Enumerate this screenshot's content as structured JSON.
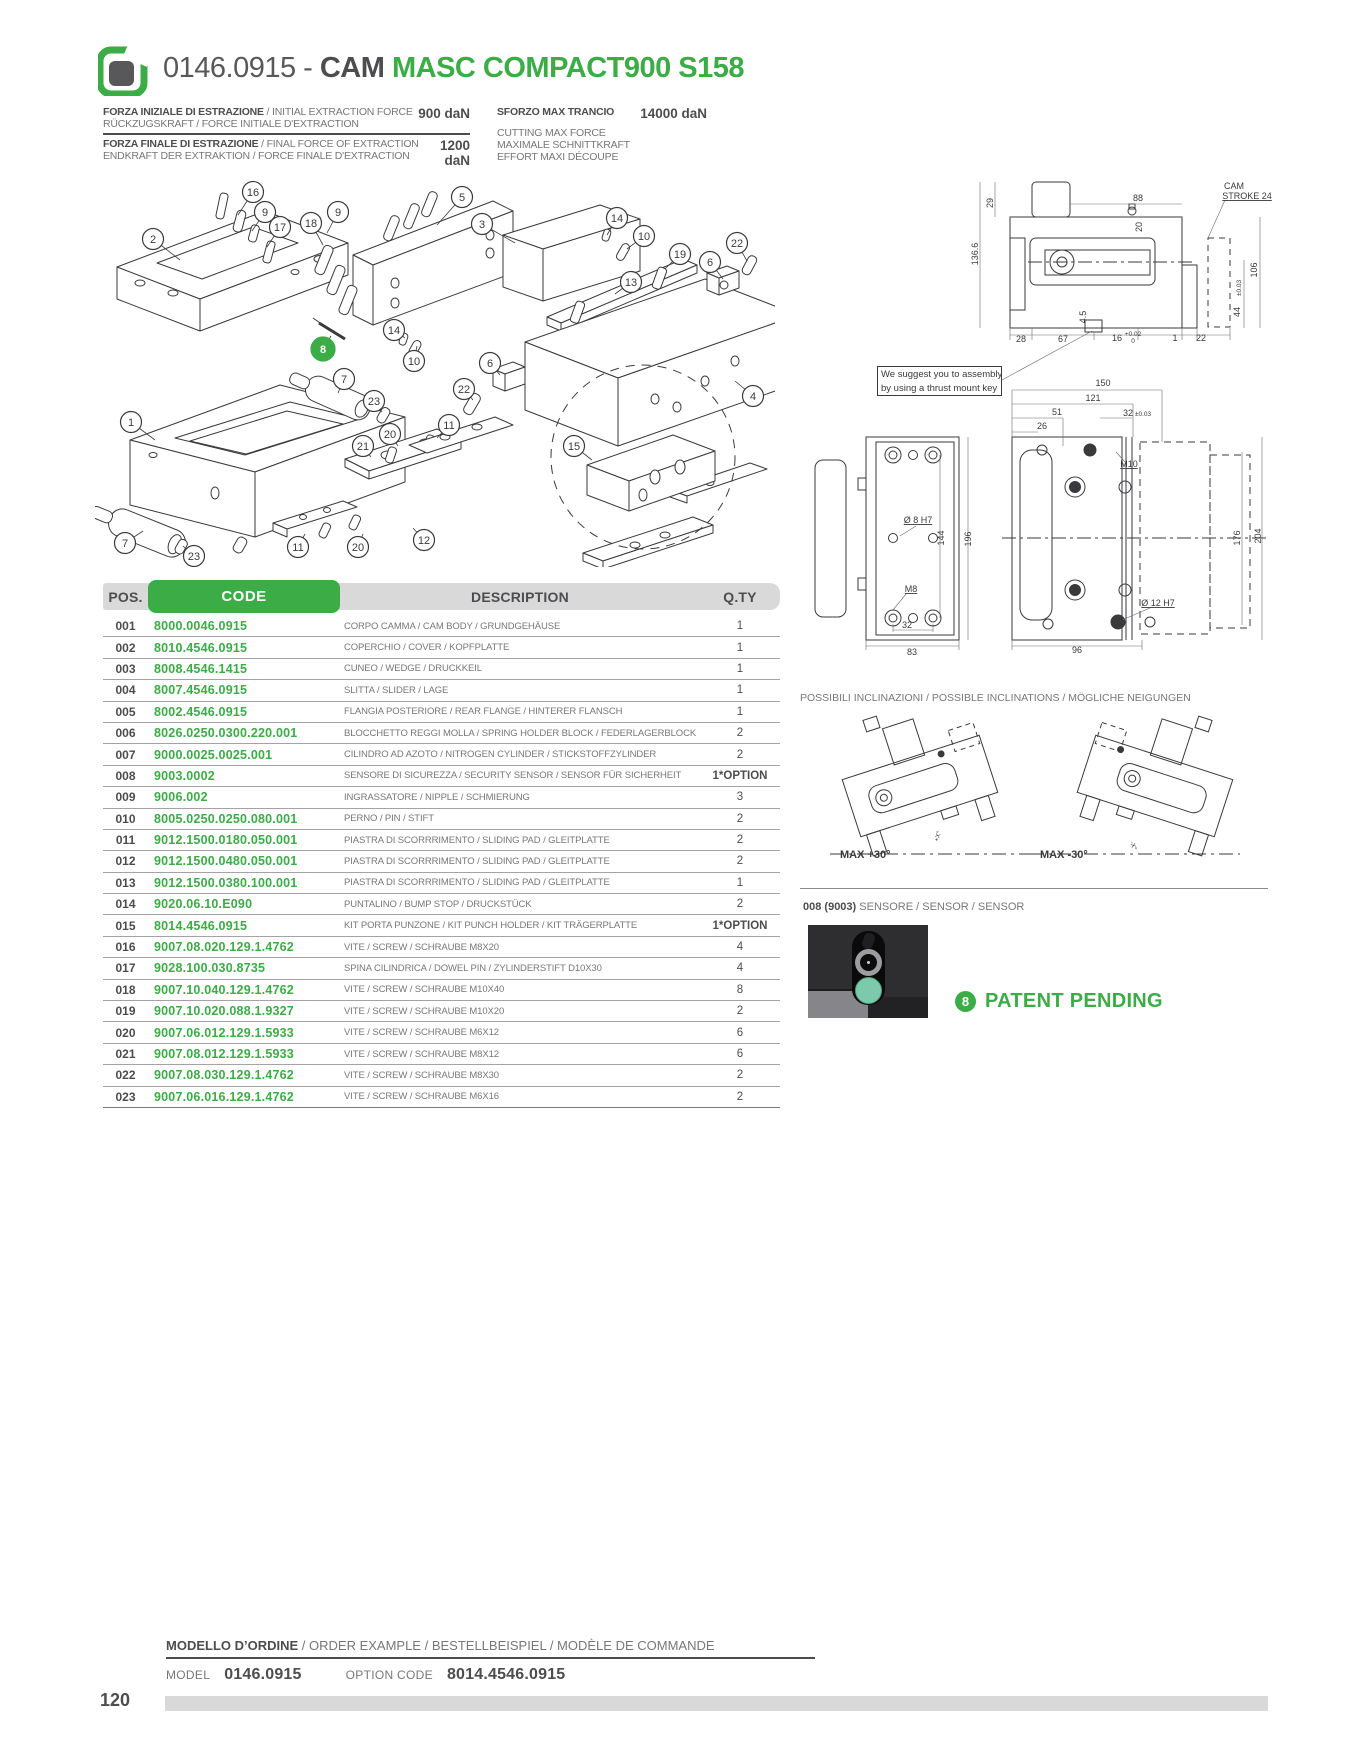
{
  "page": {
    "number": "120"
  },
  "header": {
    "code": "0146.0915 - ",
    "family": "CAM ",
    "model": "MASC COMPACT900 S158"
  },
  "specs": {
    "left": [
      {
        "line1_bold": "FORZA INIZIALE DI ESTRAZIONE",
        "line1_rest": " / INITIAL EXTRACTION FORCE",
        "line2": "RÜCKZUGSKRAFT / FORCE INITIALE D'EXTRACTION",
        "value": "900 daN"
      },
      {
        "line1_bold": "FORZA FINALE DI ESTRAZIONE",
        "line1_rest": " / FINAL FORCE OF EXTRACTION",
        "line2": "ENDKRAFT DER EXTRAKTION / FORCE FINALE D'EXTRACTION",
        "value": "1200 daN"
      }
    ],
    "right": {
      "title": "SFORZO MAX TRANCIO",
      "value": "14000 daN",
      "lines": [
        "CUTTING MAX FORCE",
        "MAXIMALE SCHNITTKRAFT",
        "EFFORT MAXI DÉCOUPE"
      ]
    }
  },
  "note": {
    "line1": "We suggest you to assembly",
    "line2": "by using a thrust mount key"
  },
  "table": {
    "headers": {
      "pos": "POS.",
      "code": "CODE",
      "description": "DESCRIPTION",
      "qty": "Q.TY"
    },
    "rows": [
      {
        "pos": "001",
        "code": "8000.0046.0915",
        "description": "CORPO CAMMA / CAM BODY / GRUNDGEHÄUSE",
        "qty": "1"
      },
      {
        "pos": "002",
        "code": "8010.4546.0915",
        "description": "COPERCHIO / COVER / KOPFPLATTE",
        "qty": "1"
      },
      {
        "pos": "003",
        "code": "8008.4546.1415",
        "description": "CUNEO / WEDGE / DRUCKKEIL",
        "qty": "1"
      },
      {
        "pos": "004",
        "code": "8007.4546.0915",
        "description": "SLITTA / SLIDER / LAGE",
        "qty": "1"
      },
      {
        "pos": "005",
        "code": "8002.4546.0915",
        "description": "FLANGIA POSTERIORE / REAR FLANGE / HINTERER FLANSCH",
        "qty": "1"
      },
      {
        "pos": "006",
        "code": "8026.0250.0300.220.001",
        "description": "BLOCCHETTO REGGI MOLLA / SPRING HOLDER BLOCK / FEDERLAGERBLOCK",
        "qty": "2"
      },
      {
        "pos": "007",
        "code": "9000.0025.0025.001",
        "description": "CILINDRO AD AZOTO / NITROGEN CYLINDER / STICKSTOFFZYLINDER",
        "qty": "2"
      },
      {
        "pos": "008",
        "code": "9003.0002",
        "description": "SENSORE DI SICUREZZA / SECURITY SENSOR / SENSOR FÜR SICHERHEIT",
        "qty": "1*OPTION"
      },
      {
        "pos": "009",
        "code": "9006.002",
        "description": "INGRASSATORE / NIPPLE / SCHMIERUNG",
        "qty": "3"
      },
      {
        "pos": "010",
        "code": "8005.0250.0250.080.001",
        "description": "PERNO / PIN / STIFT",
        "qty": "2"
      },
      {
        "pos": "011",
        "code": "9012.1500.0180.050.001",
        "description": "PIASTRA DI SCORRRIMENTO / SLIDING PAD / GLEITPLATTE",
        "qty": "2"
      },
      {
        "pos": "012",
        "code": "9012.1500.0480.050.001",
        "description": "PIASTRA DI SCORRRIMENTO / SLIDING PAD / GLEITPLATTE",
        "qty": "2"
      },
      {
        "pos": "013",
        "code": "9012.1500.0380.100.001",
        "description": "PIASTRA DI SCORRRIMENTO / SLIDING PAD / GLEITPLATTE",
        "qty": "1"
      },
      {
        "pos": "014",
        "code": "9020.06.10.E090",
        "description": "PUNTALINO / BUMP STOP / DRUCKSTÜCK",
        "qty": "2"
      },
      {
        "pos": "015",
        "code": "8014.4546.0915",
        "description": "KIT PORTA PUNZONE / KIT PUNCH HOLDER / KIT TRÄGERPLATTE",
        "qty": "1*OPTION"
      },
      {
        "pos": "016",
        "code": "9007.08.020.129.1.4762",
        "description": "VITE / SCREW / SCHRAUBE M8X20",
        "qty": "4"
      },
      {
        "pos": "017",
        "code": "9028.100.030.8735",
        "description": "SPINA CILINDRICA / DOWEL PIN / ZYLINDERSTIFT D10X30",
        "qty": "4"
      },
      {
        "pos": "018",
        "code": "9007.10.040.129.1.4762",
        "description": "VITE / SCREW / SCHRAUBE M10X40",
        "qty": "8"
      },
      {
        "pos": "019",
        "code": "9007.10.020.088.1.9327",
        "description": "VITE / SCREW / SCHRAUBE M10X20",
        "qty": "2"
      },
      {
        "pos": "020",
        "code": "9007.06.012.129.1.5933",
        "description": "VITE / SCREW / SCHRAUBE M6X12",
        "qty": "6"
      },
      {
        "pos": "021",
        "code": "9007.08.012.129.1.5933",
        "description": "VITE / SCREW / SCHRAUBE M8X12",
        "qty": "6"
      },
      {
        "pos": "022",
        "code": "9007.08.030.129.1.4762",
        "description": "VITE / SCREW / SCHRAUBE M8X30",
        "qty": "2"
      },
      {
        "pos": "023",
        "code": "9007.06.016.129.1.4762",
        "description": "VITE / SCREW / SCHRAUBE M6X16",
        "qty": "2"
      }
    ]
  },
  "balloons": [
    {
      "n": "2",
      "x": 58,
      "y": 84,
      "tx": 85,
      "ty": 105
    },
    {
      "n": "16",
      "x": 158,
      "y": 37,
      "tx": 143,
      "ty": 60
    },
    {
      "n": "9",
      "x": 170,
      "y": 57,
      "tx": 157,
      "ty": 76
    },
    {
      "n": "17",
      "x": 185,
      "y": 72,
      "tx": 172,
      "ty": 92
    },
    {
      "n": "18",
      "x": 216,
      "y": 68,
      "tx": 228,
      "ty": 90
    },
    {
      "n": "9",
      "x": 243,
      "y": 57,
      "tx": 232,
      "ty": 78
    },
    {
      "n": "5",
      "x": 367,
      "y": 42,
      "tx": 342,
      "ty": 70
    },
    {
      "n": "3",
      "x": 387,
      "y": 69,
      "tx": 420,
      "ty": 88
    },
    {
      "n": "14",
      "x": 522,
      "y": 63,
      "tx": 512,
      "ty": 80
    },
    {
      "n": "10",
      "x": 549,
      "y": 81,
      "tx": 532,
      "ty": 94
    },
    {
      "n": "19",
      "x": 585,
      "y": 99,
      "tx": 570,
      "ty": 114
    },
    {
      "n": "6",
      "x": 615,
      "y": 107,
      "tx": 628,
      "ty": 124
    },
    {
      "n": "22",
      "x": 642,
      "y": 88,
      "tx": 652,
      "ty": 106
    },
    {
      "n": "13",
      "x": 536,
      "y": 127,
      "tx": 520,
      "ty": 139
    },
    {
      "n": "14",
      "x": 299,
      "y": 175,
      "tx": 310,
      "ty": 183
    },
    {
      "n": "10",
      "x": 319,
      "y": 206,
      "tx": 322,
      "ty": 191
    },
    {
      "n": "8",
      "x": 228,
      "y": 194,
      "tx": 236,
      "ty": 181,
      "green": true
    },
    {
      "n": "7",
      "x": 249,
      "y": 224,
      "tx": 243,
      "ty": 238
    },
    {
      "n": "23",
      "x": 279,
      "y": 246,
      "tx": 287,
      "ty": 257
    },
    {
      "n": "6",
      "x": 395,
      "y": 208,
      "tx": 405,
      "ty": 220
    },
    {
      "n": "22",
      "x": 369,
      "y": 234,
      "tx": 378,
      "ty": 245
    },
    {
      "n": "1",
      "x": 36,
      "y": 267,
      "tx": 60,
      "ty": 285
    },
    {
      "n": "21",
      "x": 268,
      "y": 291,
      "tx": 276,
      "ty": 302
    },
    {
      "n": "20",
      "x": 295,
      "y": 279,
      "tx": 303,
      "ty": 291
    },
    {
      "n": "11",
      "x": 354,
      "y": 270,
      "tx": 342,
      "ty": 283
    },
    {
      "n": "15",
      "x": 479,
      "y": 291,
      "tx": 497,
      "ty": 305
    },
    {
      "n": "4",
      "x": 658,
      "y": 241,
      "tx": 640,
      "ty": 226
    },
    {
      "n": "7",
      "x": 30,
      "y": 388,
      "tx": 48,
      "ty": 376
    },
    {
      "n": "23",
      "x": 99,
      "y": 401,
      "tx": 88,
      "ty": 391
    },
    {
      "n": "11",
      "x": 203,
      "y": 392,
      "tx": 210,
      "ty": 379
    },
    {
      "n": "20",
      "x": 263,
      "y": 392,
      "tx": 268,
      "ty": 379
    },
    {
      "n": "12",
      "x": 329,
      "y": 385,
      "tx": 318,
      "ty": 373
    }
  ],
  "drawing_dims": {
    "side_view": [
      {
        "t": "29",
        "x": 263,
        "y": 53,
        "r": -90
      },
      {
        "t": "136.6",
        "x": 248,
        "y": 104,
        "r": -90
      },
      {
        "t": "88",
        "x": 408,
        "y": 51
      },
      {
        "t": "20",
        "x": 412,
        "y": 77,
        "r": -90
      },
      {
        "t": "CAM",
        "x": 504,
        "y": 39
      },
      {
        "t": "STROKE 24",
        "x": 517,
        "y": 49,
        "u": true
      },
      {
        "t": "106",
        "x": 527,
        "y": 120,
        "r": -90
      },
      {
        "t": "±0.03",
        "x": 511,
        "y": 138,
        "r": -90,
        "small": true
      },
      {
        "t": "44",
        "x": 510,
        "y": 162,
        "r": -90
      },
      {
        "t": "28",
        "x": 291,
        "y": 192
      },
      {
        "t": "67",
        "x": 333,
        "y": 192
      },
      {
        "t": "4.5",
        "x": 356,
        "y": 167,
        "r": -90
      },
      {
        "t": "16",
        "x": 387,
        "y": 191
      },
      {
        "t": "+0.02",
        "x": 403,
        "y": 186,
        "small": true
      },
      {
        "t": "0",
        "x": 403,
        "y": 193,
        "small": true
      },
      {
        "t": "1",
        "x": 445,
        "y": 191
      },
      {
        "t": "22",
        "x": 471,
        "y": 191
      }
    ],
    "plan_view": [
      {
        "t": "150",
        "x": 373,
        "y": 236
      },
      {
        "t": "121",
        "x": 363,
        "y": 251
      },
      {
        "t": "51",
        "x": 327,
        "y": 265
      },
      {
        "t": "32",
        "x": 398,
        "y": 266
      },
      {
        "t": "±0.03",
        "x": 413,
        "y": 266,
        "small": true
      },
      {
        "t": "26",
        "x": 312,
        "y": 279
      },
      {
        "t": "M10",
        "x": 399,
        "y": 317,
        "u": true
      },
      {
        "t": "Ø 8  H7",
        "x": 188,
        "y": 373,
        "u": true
      },
      {
        "t": "144",
        "x": 214,
        "y": 388,
        "r": -90
      },
      {
        "t": "196",
        "x": 241,
        "y": 389,
        "r": -90
      },
      {
        "t": "M8",
        "x": 181,
        "y": 442,
        "u": true
      },
      {
        "t": "32",
        "x": 177,
        "y": 478
      },
      {
        "t": "83",
        "x": 182,
        "y": 505
      },
      {
        "t": "96",
        "x": 347,
        "y": 503
      },
      {
        "t": "Ø 12  H7",
        "x": 428,
        "y": 456,
        "u": true
      },
      {
        "t": "176",
        "x": 510,
        "y": 388,
        "r": -90
      },
      {
        "t": "204",
        "x": 531,
        "y": 386,
        "r": -90
      }
    ]
  },
  "inclinations": {
    "title": "POSSIBILI INCLINAZIONI / POSSIBLE INCLINATIONS / MÖGLICHE NEIGUNGEN",
    "left_label": "MAX +30°",
    "right_label": "MAX -30°",
    "left_angle": "+X°",
    "right_angle": "-X°"
  },
  "sensor": {
    "label_bold": "008 (9003)",
    "label_rest": " SENSORE / SENSOR / SENSOR"
  },
  "patent": {
    "badge": "8",
    "text": "PATENT PENDING"
  },
  "order": {
    "title_bold": "MODELLO D’ORDINE",
    "title_rest": " / ORDER EXAMPLE / BESTELLBEISPIEL / MODÈLE DE COMMANDE",
    "model_label": "MODEL",
    "model_value": "0146.0915",
    "option_label": "OPTION CODE",
    "option_value": "8014.4546.0915"
  },
  "colors": {
    "green": "#3bac46",
    "dark": "#4d4d4f",
    "gray_text": "#77777a",
    "bar": "#d9d9da"
  }
}
